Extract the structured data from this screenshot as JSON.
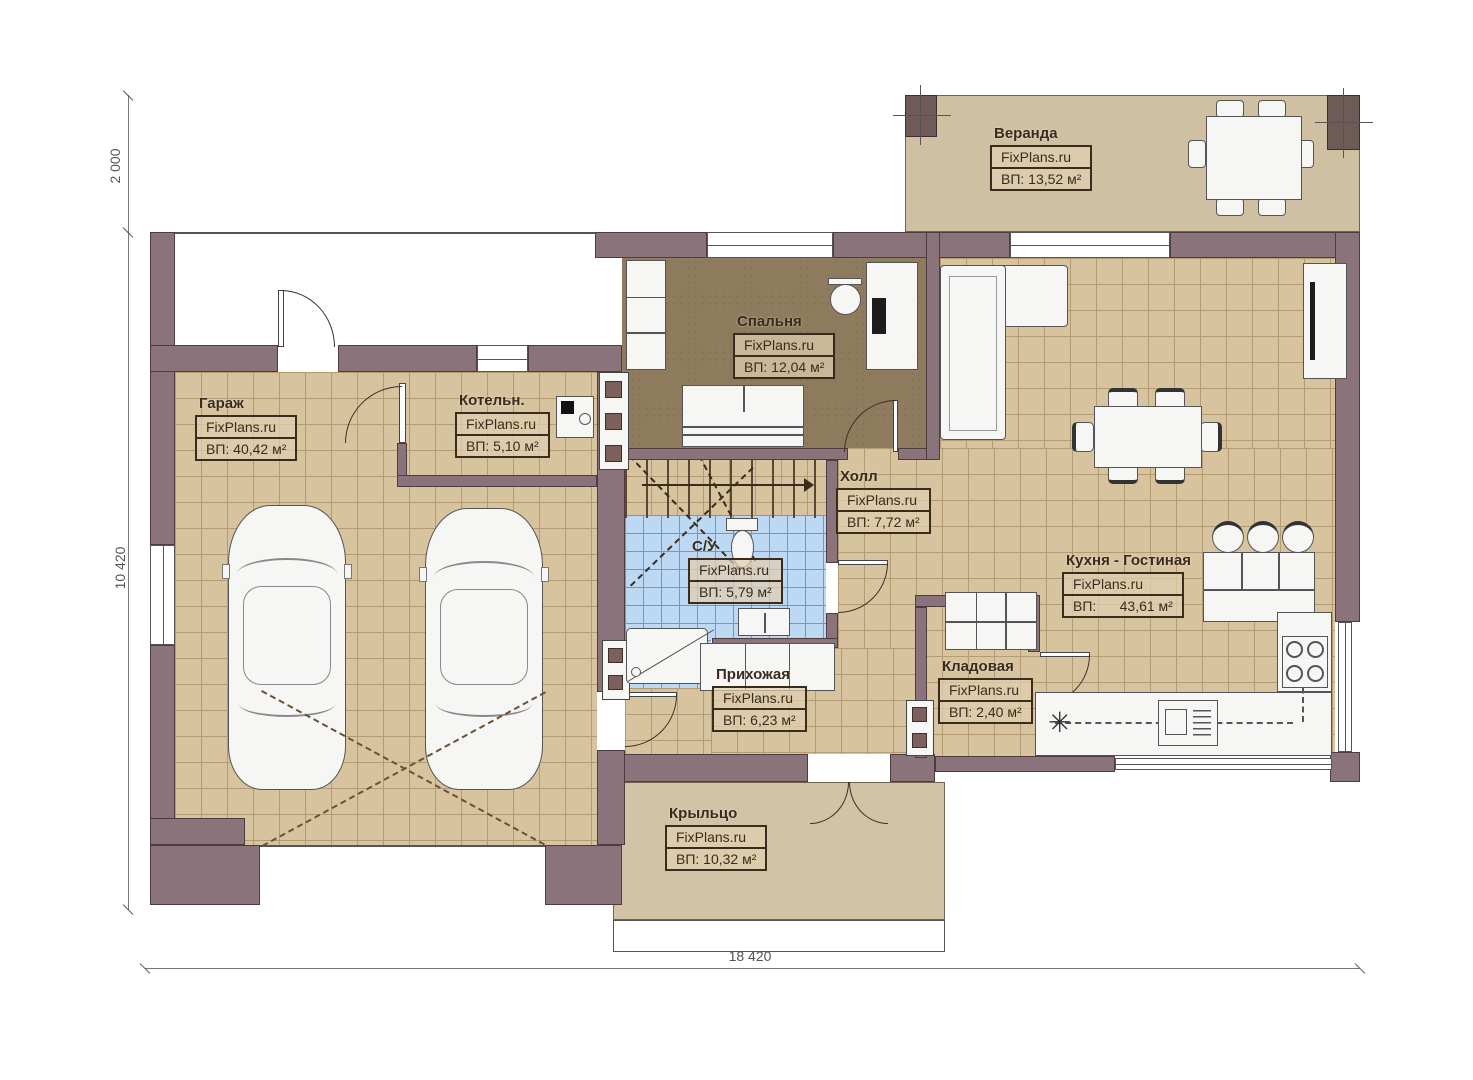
{
  "plan": {
    "brand": "FixPlans.ru",
    "rooms": {
      "veranda": {
        "name": "Веранда",
        "area": "ВП: 13,52 м²"
      },
      "bedroom": {
        "name": "Спальня",
        "area": "ВП: 12,04 м²"
      },
      "garage": {
        "name": "Гараж",
        "area": "ВП: 40,42 м²"
      },
      "boiler": {
        "name": "Котельн.",
        "area": "ВП: 5,10 м²"
      },
      "hall": {
        "name": "Холл",
        "area": "ВП: 7,72 м²"
      },
      "bathroom": {
        "name": "С/У",
        "area": "ВП: 5,79 м²"
      },
      "hallway": {
        "name": "Прихожая",
        "area": "ВП: 6,23 м²"
      },
      "storage": {
        "name": "Кладовая",
        "area": "ВП: 2,40 м²"
      },
      "kitchen_living": {
        "name": "Кухня - Гостиная",
        "area": "ВП:      43,61 м²"
      },
      "porch": {
        "name": "Крыльцо",
        "area": "ВП: 10,32 м²"
      }
    },
    "dimensions": {
      "top_left_height": "2 000",
      "left_height": "10 420",
      "bottom_width": "18 420"
    },
    "symbols": {
      "fridge": "✳"
    },
    "colors": {
      "wall": "#8a737a",
      "floor_tile": "#d7c39e",
      "bedroom_floor": "#8f7c5e",
      "bathroom_tile": "#bcd8f2",
      "veranda_floor": "#d0c1a4",
      "label_ink": "#3a2c1c"
    }
  }
}
